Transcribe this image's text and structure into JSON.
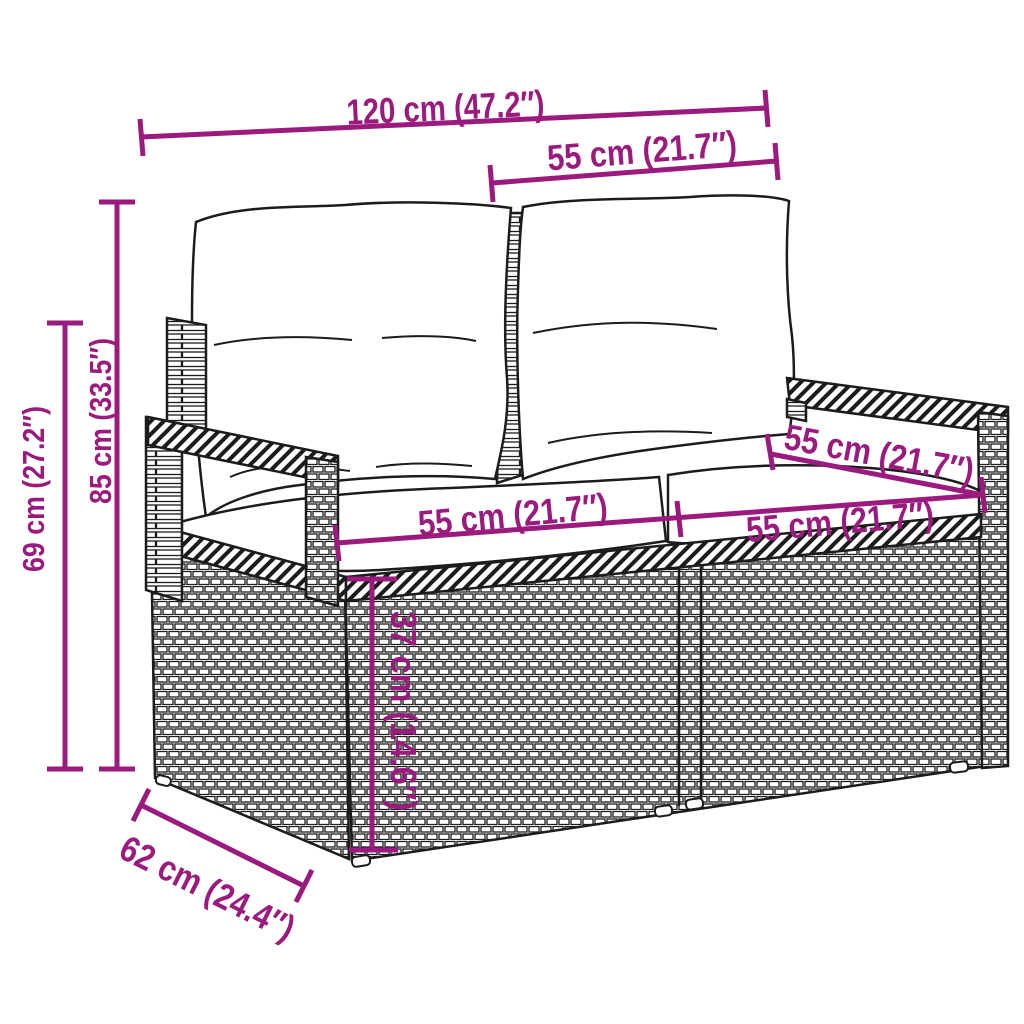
{
  "diagram": {
    "kind": "product-dimension-diagram",
    "subject": "poly-rattan 2-seater garden sofa with back and seat cushions",
    "style": "black line-art on white with magenta dimension annotations",
    "background_color": "#ffffff",
    "accent_color": "#9B1A7E",
    "line_art_color": "#1c1c1c"
  },
  "dimensions": {
    "overall_width": {
      "label": "120 cm (47.2″)"
    },
    "seat_width_top": {
      "label": "55 cm (21.7″)"
    },
    "total_height": {
      "label": "85 cm (33.5″)"
    },
    "arm_height": {
      "label": "69 cm (27.2″)"
    },
    "seat_width_left": {
      "label": "55 cm (21.7″)"
    },
    "seat_width_right": {
      "label": "55 cm (21.7″)"
    },
    "seat_depth": {
      "label": "55 cm (21.7″)"
    },
    "seat_height": {
      "label": "37 cm (14.6″)"
    },
    "overall_depth": {
      "label": "62 cm (24.4″)"
    }
  }
}
